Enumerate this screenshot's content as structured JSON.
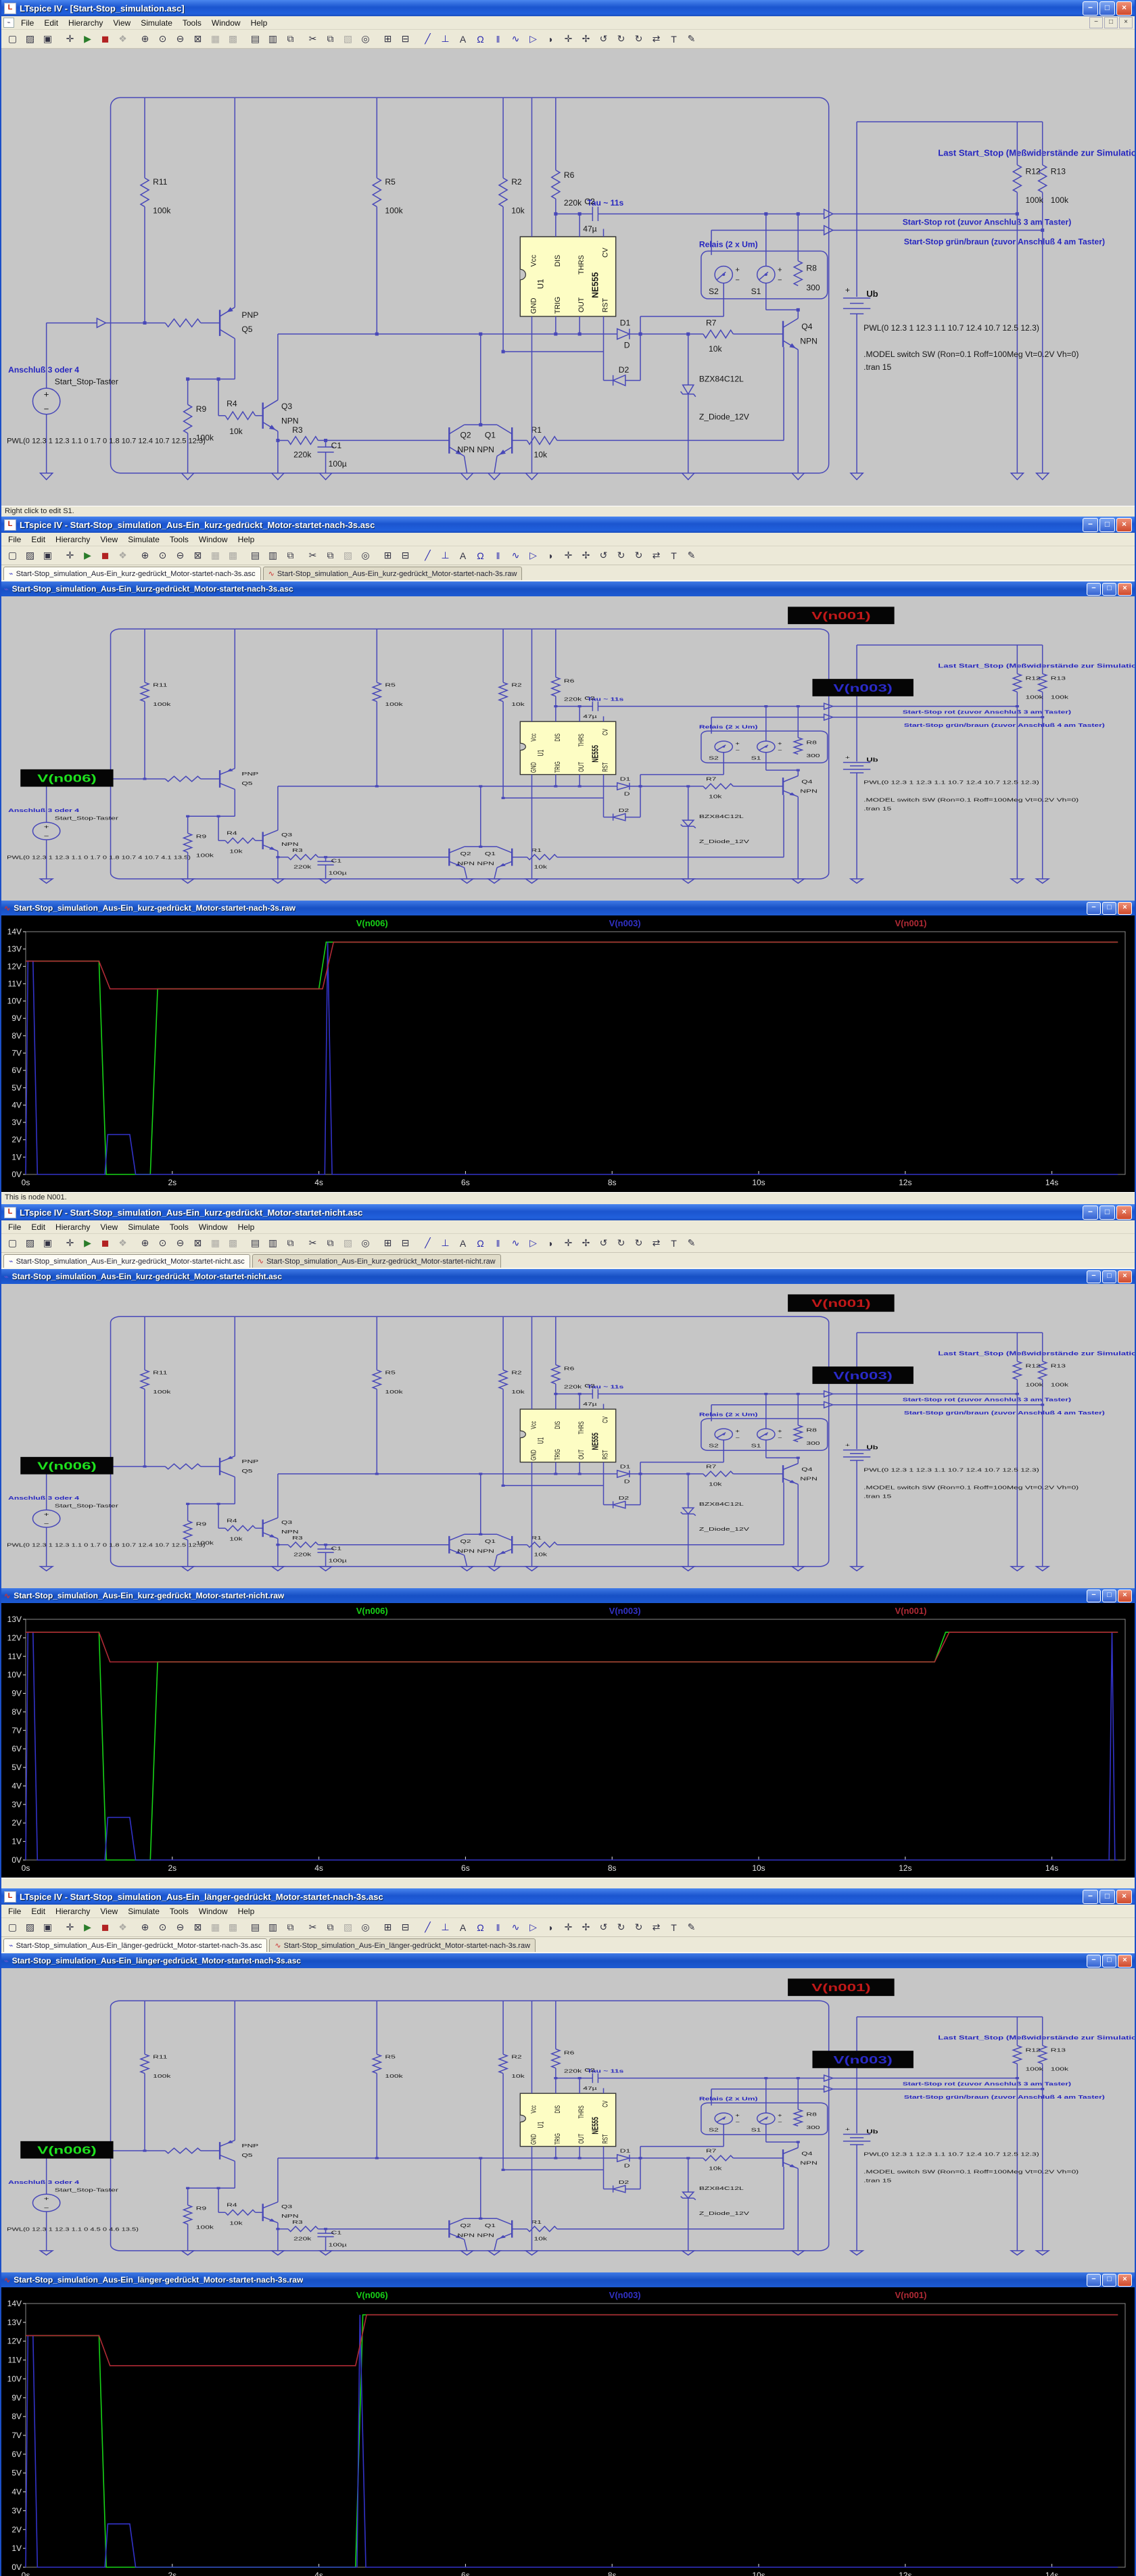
{
  "app": {
    "name": "LTspice IV",
    "menu": [
      "File",
      "Edit",
      "Hierarchy",
      "View",
      "Simulate",
      "Tools",
      "Window",
      "Help"
    ],
    "toolbar_icons": [
      "new-schematic",
      "open",
      "save",
      "control-panel",
      "run",
      "halt",
      "pan",
      "zoom-in",
      "zoom-back",
      "zoom-out",
      "zoom-full-extents",
      "grid-dots",
      "mark-unconnected",
      "tile-horizontal",
      "tile-vertical",
      "cascade",
      "cut",
      "copy",
      "paste",
      "find",
      "print-preview",
      "print",
      "wire",
      "ground",
      "net-label",
      "resistor",
      "capacitor",
      "inductor",
      "diode",
      "component",
      "move",
      "drag",
      "undo",
      "redo",
      "rotate",
      "mirror",
      "text",
      "edit"
    ],
    "window_buttons": [
      "minimize",
      "maximize",
      "close"
    ]
  },
  "windows": [
    {
      "title": "LTspice IV - [Start-Stop_simulation.asc]",
      "status": "Right click to edit S1."
    },
    {
      "title": "LTspice IV - Start-Stop_simulation_Aus-Ein_kurz-gedrückt_Motor-startet-nach-3s.asc",
      "tabs": [
        "Start-Stop_simulation_Aus-Ein_kurz-gedrückt_Motor-startet-nach-3s.asc",
        "Start-Stop_simulation_Aus-Ein_kurz-gedrückt_Motor-startet-nach-3s.raw"
      ],
      "child_title": "Start-Stop_simulation_Aus-Ein_kurz-gedrückt_Motor-startet-nach-3s.asc"
    },
    {
      "title": "Start-Stop_simulation_Aus-Ein_kurz-gedrückt_Motor-startet-nach-3s.raw",
      "status": "This is node N001."
    },
    {
      "title": "LTspice IV - Start-Stop_simulation_Aus-Ein_kurz-gedrückt_Motor-startet-nicht.asc",
      "tabs": [
        "Start-Stop_simulation_Aus-Ein_kurz-gedrückt_Motor-startet-nicht.asc",
        "Start-Stop_simulation_Aus-Ein_kurz-gedrückt_Motor-startet-nicht.raw"
      ],
      "child_title": "Start-Stop_simulation_Aus-Ein_kurz-gedrückt_Motor-startet-nicht.asc"
    },
    {
      "title": "Start-Stop_simulation_Aus-Ein_kurz-gedrückt_Motor-startet-nicht.raw",
      "status": ""
    },
    {
      "title": "LTspice IV - Start-Stop_simulation_Aus-Ein_länger-gedrückt_Motor-startet-nach-3s.asc",
      "tabs": [
        "Start-Stop_simulation_Aus-Ein_länger-gedrückt_Motor-startet-nach-3s.asc",
        "Start-Stop_simulation_Aus-Ein_länger-gedrückt_Motor-startet-nach-3s.raw"
      ],
      "child_title": "Start-Stop_simulation_Aus-Ein_länger-gedrückt_Motor-startet-nach-3s.asc"
    },
    {
      "title": "Start-Stop_simulation_Aus-Ein_länger-gedrückt_Motor-startet-nach-3s.raw"
    }
  ],
  "schematic": {
    "components": {
      "R1": "10k",
      "R2": "10k",
      "R3": "220k",
      "R4": "10k",
      "R5": "100k",
      "R6": "220k",
      "R7": "10k",
      "R8": "300",
      "R9": "100k",
      "R10": "10k",
      "R11": "100k",
      "R12": "100k",
      "R13": "100k",
      "C1": "100µ",
      "C2": "47µ",
      "U1": "U1",
      "U1_type": "NE555",
      "Q1": "Q1",
      "Q2": "Q2",
      "Q3": "Q3",
      "Q4": "Q4",
      "Q5": "Q5",
      "NPN": "NPN",
      "PNP": "PNP",
      "NPNNPN": "NPN NPN",
      "D1": "D1",
      "D1_val": "D",
      "D2": "D2",
      "S1": "S1",
      "S2": "S2",
      "UB": "Ub",
      "DZ_name": "BZX84C12L",
      "DZ_val": "Z_Diode_12V"
    },
    "pins": [
      "Vcc",
      "DIS",
      "THRS",
      "CV",
      "GND",
      "TRIG",
      "OUT",
      "RST"
    ],
    "comments": {
      "tau": "Tau ~ 11s",
      "relais": "Relais (2 x Um)",
      "anschluss": "Anschluß 3 oder 4",
      "taster": "Start_Stop-Taster",
      "last": "Last Start_Stop (Meßwiderstände zur Simulation)",
      "rot": "Start-Stop rot (zuvor Anschluß 3 am Taster)",
      "gruen": "Start-Stop grün/braun (zuvor Anschluß 4 am Taster)"
    },
    "directives": {
      "pwl_ub": "PWL(0 12.3 1 12.3 1.1 10.7 12.4 10.7 12.5 12.3)",
      "model": ".MODEL switch SW (Ron=0.1 Roff=100Meg Vt=0.2V Vh=0)",
      "tran": ".tran 15"
    },
    "net_labels": {
      "v6": "V(n006)",
      "v1": "V(n001)",
      "v3": "V(n003)"
    },
    "variants": {
      "main": {
        "pwl": "PWL(0 12.3 1 12.3 1.1 0 1.7 0 1.8 10.7 12.4 10.7 12.5 12.3)",
        "chips": false
      },
      "kurz3s": {
        "pwl": "PWL(0 12.3 1 12.3 1.1 0 1.7 0 1.8 10.7 4 10.7 4.1 13.5)",
        "chips": true
      },
      "nicht": {
        "pwl": "PWL(0 12.3 1 12.3 1.1 0 1.7 0 1.8 10.7 12.4 10.7 12.5 12.3)",
        "chips": true
      },
      "laenger": {
        "pwl": "PWL(0 12.3 1 12.3 1.1 0 4.5 0 4.6 13.5)",
        "chips": true
      }
    },
    "colors": {
      "wire": "#4848b8",
      "comment": "#2626c0",
      "text": "#161616",
      "chip_bg": "#050505",
      "chip_green": "#1ee11e",
      "chip_red": "#c01818",
      "chip_blue": "#2a2ac8",
      "ic_fill": "#fdfdc4"
    }
  },
  "chart_data": [
    {
      "type": "line",
      "title": "Start-Stop_simulation_Aus-Ein_kurz-gedrückt_Motor-startet-nach-3s.raw",
      "xlabel": "time",
      "ylabel": "V",
      "xlim": [
        0,
        15
      ],
      "ylim": [
        0,
        14
      ],
      "xticks": [
        0,
        2,
        4,
        6,
        8,
        10,
        12,
        14
      ],
      "ytick_step": 1,
      "grid": false,
      "legend_position": "top",
      "series": [
        {
          "name": "V(n006)",
          "color": "#17d317",
          "points": [
            [
              0,
              12.3
            ],
            [
              1,
              12.3
            ],
            [
              1.1,
              0
            ],
            [
              1.7,
              0
            ],
            [
              1.8,
              10.7
            ],
            [
              4,
              10.7
            ],
            [
              4.1,
              13.4
            ],
            [
              14.9,
              13.4
            ]
          ]
        },
        {
          "name": "V(n003)",
          "color": "#3232c8",
          "points": [
            [
              0,
              0
            ],
            [
              0.03,
              12.3
            ],
            [
              0.1,
              12.3
            ],
            [
              0.16,
              0
            ],
            [
              1.08,
              0
            ],
            [
              1.12,
              2.3
            ],
            [
              1.42,
              2.3
            ],
            [
              1.5,
              0
            ],
            [
              4.08,
              0
            ],
            [
              4.12,
              13.4
            ],
            [
              4.18,
              0
            ],
            [
              14.9,
              0
            ]
          ]
        },
        {
          "name": "V(n001)",
          "color": "#b02a35",
          "points": [
            [
              0,
              12.3
            ],
            [
              1,
              12.3
            ],
            [
              1.15,
              10.7
            ],
            [
              4.05,
              10.7
            ],
            [
              4.2,
              13.4
            ],
            [
              14.9,
              13.4
            ]
          ]
        }
      ]
    },
    {
      "type": "line",
      "title": "Start-Stop_simulation_Aus-Ein_kurz-gedrückt_Motor-startet-nicht.raw",
      "xlabel": "time",
      "ylabel": "V",
      "xlim": [
        0,
        15
      ],
      "ylim": [
        0,
        13
      ],
      "xticks": [
        0,
        2,
        4,
        6,
        8,
        10,
        12,
        14
      ],
      "ytick_step": 1,
      "grid": false,
      "legend_position": "top",
      "series": [
        {
          "name": "V(n006)",
          "color": "#17d317",
          "points": [
            [
              0,
              12.3
            ],
            [
              1,
              12.3
            ],
            [
              1.1,
              0
            ],
            [
              1.7,
              0
            ],
            [
              1.8,
              10.7
            ],
            [
              12.4,
              10.7
            ],
            [
              12.55,
              12.3
            ],
            [
              14.9,
              12.3
            ]
          ]
        },
        {
          "name": "V(n003)",
          "color": "#3232c8",
          "points": [
            [
              0,
              0
            ],
            [
              0.03,
              12.3
            ],
            [
              0.1,
              12.3
            ],
            [
              0.16,
              0
            ],
            [
              1.08,
              0
            ],
            [
              1.12,
              2.3
            ],
            [
              1.42,
              2.3
            ],
            [
              1.5,
              0
            ],
            [
              14.78,
              0
            ],
            [
              14.82,
              12.3
            ],
            [
              14.86,
              0
            ],
            [
              14.9,
              0
            ]
          ]
        },
        {
          "name": "V(n001)",
          "color": "#b02a35",
          "points": [
            [
              0,
              12.3
            ],
            [
              1,
              12.3
            ],
            [
              1.15,
              10.7
            ],
            [
              12.4,
              10.7
            ],
            [
              12.6,
              12.3
            ],
            [
              14.9,
              12.3
            ]
          ]
        }
      ]
    },
    {
      "type": "line",
      "title": "Start-Stop_simulation_Aus-Ein_länger-gedrückt_Motor-startet-nach-3s.raw",
      "xlabel": "time",
      "ylabel": "V",
      "xlim": [
        0,
        15
      ],
      "ylim": [
        0,
        14
      ],
      "xticks": [
        0,
        2,
        4,
        6,
        8,
        10,
        12,
        14
      ],
      "ytick_step": 1,
      "grid": false,
      "legend_position": "top",
      "series": [
        {
          "name": "V(n006)",
          "color": "#17d317",
          "points": [
            [
              0,
              12.3
            ],
            [
              1,
              12.3
            ],
            [
              1.1,
              0
            ],
            [
              4.5,
              0
            ],
            [
              4.6,
              13.4
            ],
            [
              14.9,
              13.4
            ]
          ]
        },
        {
          "name": "V(n003)",
          "color": "#3232c8",
          "points": [
            [
              0,
              0
            ],
            [
              0.03,
              12.3
            ],
            [
              0.1,
              12.3
            ],
            [
              0.16,
              0
            ],
            [
              1.08,
              0
            ],
            [
              1.12,
              2.3
            ],
            [
              1.42,
              2.3
            ],
            [
              1.5,
              0
            ],
            [
              4.52,
              0
            ],
            [
              4.56,
              13.4
            ],
            [
              4.64,
              0
            ],
            [
              14.9,
              0
            ]
          ]
        },
        {
          "name": "V(n001)",
          "color": "#b02a35",
          "points": [
            [
              0,
              12.3
            ],
            [
              1,
              12.3
            ],
            [
              1.15,
              10.7
            ],
            [
              4.5,
              10.7
            ],
            [
              4.65,
              13.4
            ],
            [
              14.9,
              13.4
            ]
          ]
        }
      ]
    }
  ]
}
